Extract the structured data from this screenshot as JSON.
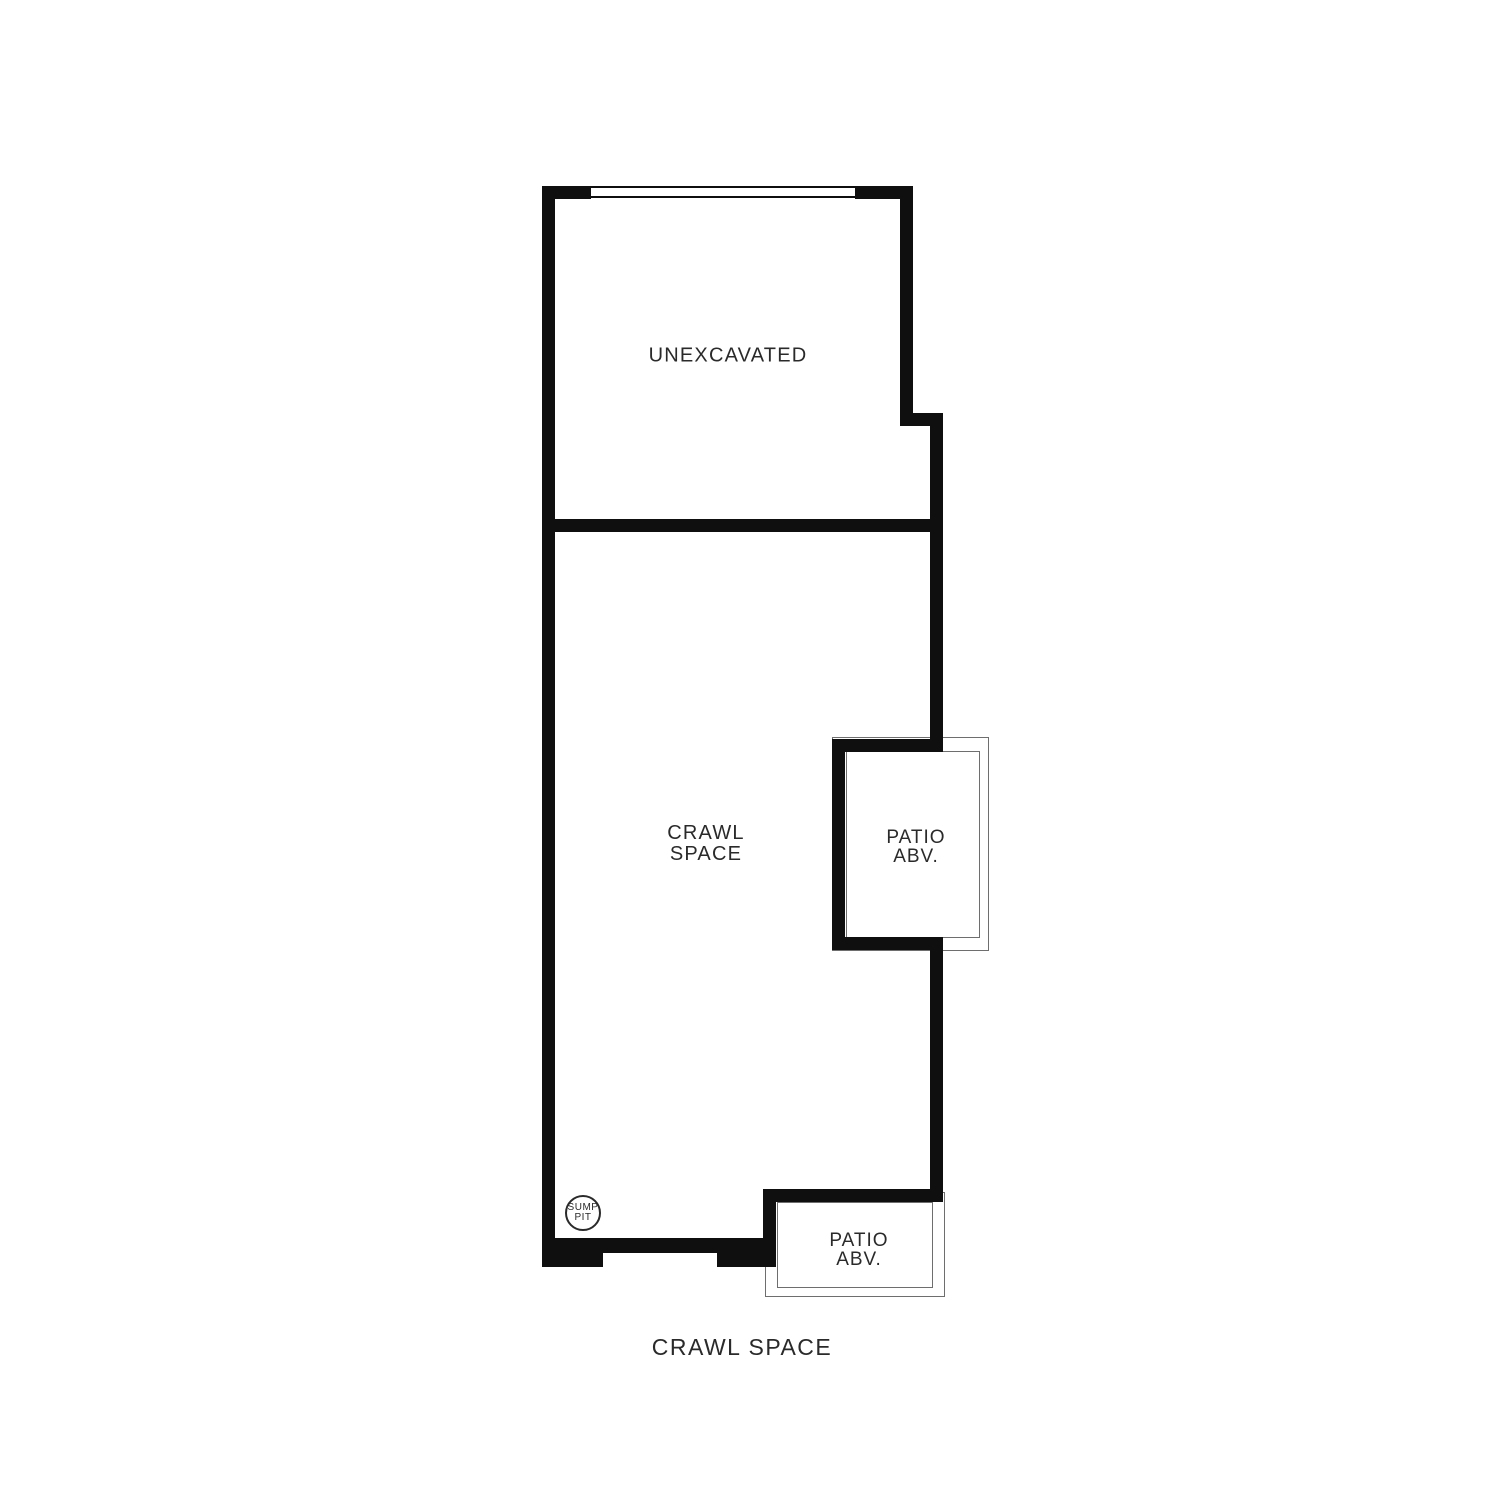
{
  "plan": {
    "title": "CRAWL SPACE",
    "rooms": {
      "unexcavated": {
        "label": "UNEXCAVATED"
      },
      "crawl_space": {
        "label_line1": "CRAWL",
        "label_line2": "SPACE"
      },
      "patio_right": {
        "label_line1": "PATIO",
        "label_line2": "ABV."
      },
      "patio_bottom": {
        "label_line1": "PATIO",
        "label_line2": "ABV."
      },
      "sump_pit": {
        "label_line1": "SUMP",
        "label_line2": "PIT"
      }
    },
    "colors": {
      "wall": "#0f0f0f",
      "thin_line": "#6e6e6e",
      "text": "#2a2a2a",
      "background": "#ffffff"
    }
  }
}
